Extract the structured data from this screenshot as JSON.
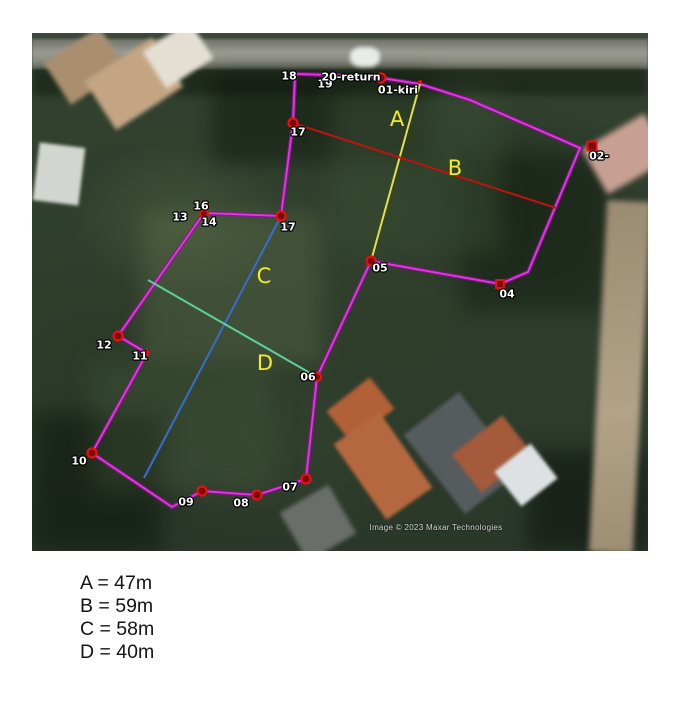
{
  "map": {
    "attribution": "Image © 2023 Maxar Technologies",
    "colors": {
      "boundary": "#e23ae2",
      "boundary_halo": "#8d1390",
      "line_A": "#e3e04a",
      "line_B": "#bc1410",
      "line_C": "#3a6cd0",
      "line_D": "#5ccf9b",
      "measure_label": "#f2ee1d",
      "point_label": "#ffffff",
      "marker_core": "#7d0a0a",
      "marker_ring": "#e31212"
    },
    "boundary_points": [
      [
        297,
        74
      ],
      [
        330,
        75
      ],
      [
        381,
        78
      ],
      [
        420,
        84
      ],
      [
        470,
        100
      ],
      [
        580,
        148
      ],
      [
        528,
        272
      ],
      [
        500,
        284
      ],
      [
        371,
        261
      ],
      [
        317,
        377
      ],
      [
        306,
        479
      ],
      [
        257,
        495
      ],
      [
        202,
        491
      ],
      [
        172,
        507
      ],
      [
        92,
        453
      ],
      [
        147,
        353
      ],
      [
        118,
        336
      ],
      [
        204,
        213
      ],
      [
        281,
        216
      ],
      [
        293,
        123
      ],
      [
        295,
        76
      ]
    ],
    "measure_lines": [
      {
        "id": "A",
        "label": "A",
        "from": [
          420,
          84
        ],
        "to": [
          371,
          261
        ],
        "color": "line_A",
        "label_pos": [
          397,
          119
        ]
      },
      {
        "id": "B",
        "label": "B",
        "from": [
          293,
          123
        ],
        "to": [
          556,
          208
        ],
        "color": "line_B",
        "label_pos": [
          455,
          168
        ]
      },
      {
        "id": "C",
        "label": "C",
        "from": [
          281,
          216
        ],
        "to": [
          144,
          478
        ],
        "color": "line_C",
        "label_pos": [
          264,
          276
        ]
      },
      {
        "id": "D",
        "label": "D",
        "from": [
          148,
          280
        ],
        "to": [
          317,
          377
        ],
        "color": "line_D",
        "label_pos": [
          265,
          363
        ]
      }
    ],
    "markers": [
      {
        "id": "18",
        "label": "18",
        "lx": 289,
        "ly": 76
      },
      {
        "id": "19",
        "label": "19",
        "lx": 325,
        "ly": 84
      },
      {
        "id": "20-return",
        "label": "20-return",
        "lx": 351,
        "ly": 77,
        "shape": "circle",
        "r": 4.5,
        "x": 381,
        "y": 78
      },
      {
        "id": "01-kiri",
        "label": "01-kiri",
        "lx": 398,
        "ly": 90,
        "shape": "circle",
        "r": 2,
        "x": 420,
        "y": 82
      },
      {
        "id": "02",
        "label": "02-",
        "lx": 599,
        "ly": 156,
        "shape": "square",
        "r": 4.5,
        "x": 592,
        "y": 146
      },
      {
        "id": "04",
        "label": "04",
        "lx": 507,
        "ly": 294,
        "shape": "square",
        "r": 4,
        "x": 500,
        "y": 284
      },
      {
        "id": "05",
        "label": "05",
        "lx": 380,
        "ly": 268,
        "shape": "circle",
        "r": 4.5,
        "x": 371,
        "y": 261
      },
      {
        "id": "06",
        "label": "06",
        "lx": 308,
        "ly": 377,
        "shape": "circle",
        "r": 4,
        "x": 317,
        "y": 377
      },
      {
        "id": "07",
        "label": "07",
        "lx": 290,
        "ly": 487,
        "shape": "circle",
        "r": 4.5,
        "x": 306,
        "y": 479
      },
      {
        "id": "08",
        "label": "08",
        "lx": 241,
        "ly": 503,
        "shape": "circle",
        "r": 4.5,
        "x": 257,
        "y": 495
      },
      {
        "id": "09",
        "label": "09",
        "lx": 186,
        "ly": 502,
        "shape": "circle",
        "r": 4.5,
        "x": 202,
        "y": 491
      },
      {
        "id": "10",
        "label": "10",
        "lx": 79,
        "ly": 461,
        "shape": "circle",
        "r": 4.5,
        "x": 92,
        "y": 453
      },
      {
        "id": "11",
        "label": "11",
        "lx": 140,
        "ly": 356,
        "shape": "circle",
        "r": 3,
        "x": 147,
        "y": 353
      },
      {
        "id": "12",
        "label": "12",
        "lx": 104,
        "ly": 345,
        "shape": "circle",
        "r": 4.5,
        "x": 118,
        "y": 336
      },
      {
        "id": "13",
        "label": "13",
        "lx": 180,
        "ly": 217
      },
      {
        "id": "14",
        "label": "14",
        "lx": 209,
        "ly": 222,
        "shape": "circle",
        "r": 4,
        "x": 204,
        "y": 214
      },
      {
        "id": "16",
        "label": "16",
        "lx": 201,
        "ly": 206,
        "shape": "circle",
        "r": 2,
        "x": 208,
        "y": 205
      },
      {
        "id": "17-top",
        "label": "17",
        "lx": 298,
        "ly": 132,
        "shape": "circle",
        "r": 4.5,
        "x": 293,
        "y": 123
      },
      {
        "id": "17-mid",
        "label": "17",
        "lx": 288,
        "ly": 227,
        "shape": "circle",
        "r": 4.5,
        "x": 281,
        "y": 216
      }
    ]
  },
  "legend": {
    "items": [
      {
        "text": "A = 47m"
      },
      {
        "text": "B = 59m"
      },
      {
        "text": "C = 58m"
      },
      {
        "text": "D = 40m"
      }
    ]
  }
}
